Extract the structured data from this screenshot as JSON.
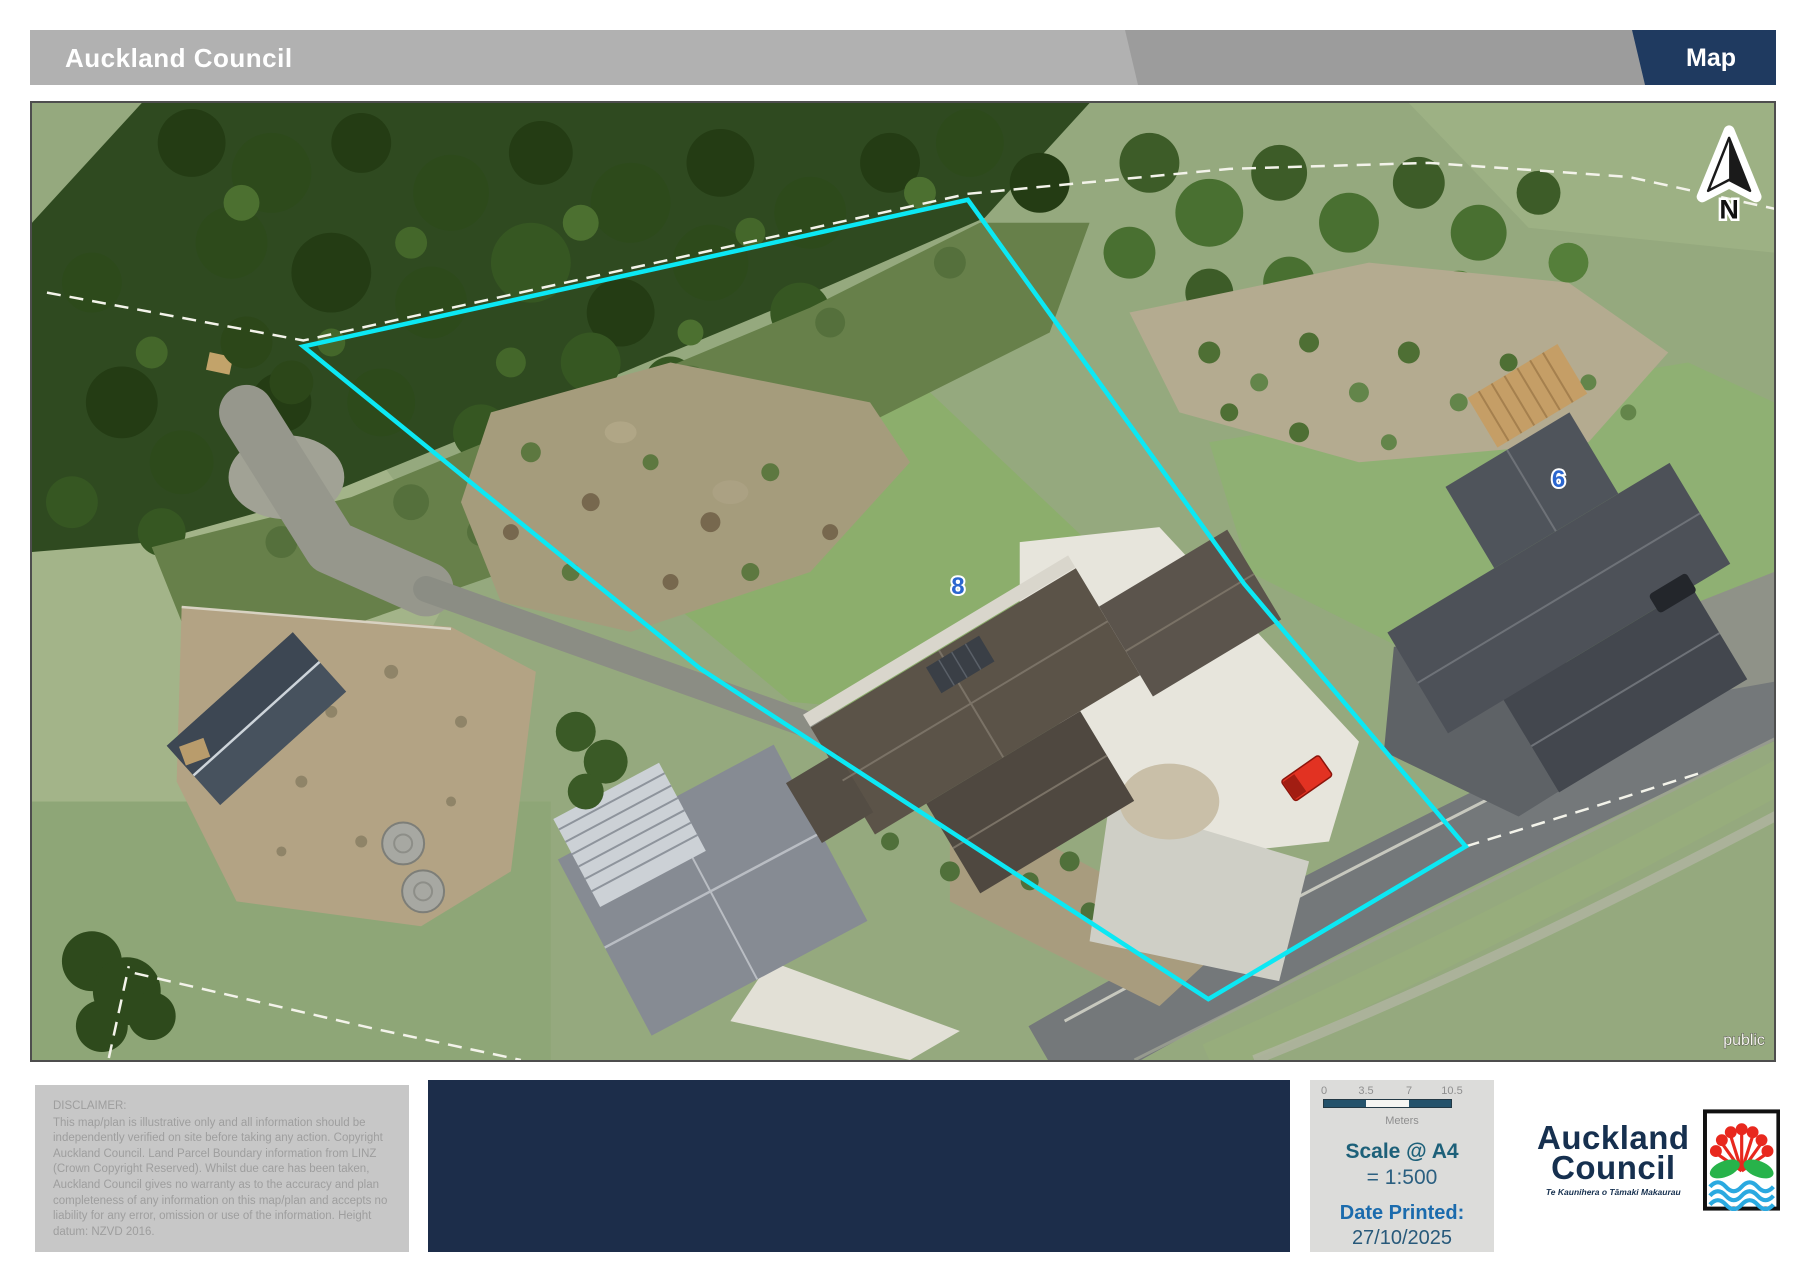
{
  "header": {
    "title": "Auckland Council",
    "tab": "Map"
  },
  "map": {
    "labels": {
      "house_8": "8",
      "house_6": "6",
      "public": "public",
      "north": "N"
    },
    "boundary_color": "#0CE8F4"
  },
  "footer": {
    "disclaimer": {
      "title": "DISCLAIMER:",
      "body": "This map/plan is illustrative only and all information should be independently verified on site before taking any action. Copyright Auckland Council.  Land Parcel Boundary information from LINZ (Crown Copyright Reserved). Whilst due care has been taken, Auckland Council gives no warranty as to the accuracy and plan completeness of any information on this map/plan and accepts no liability for any error, omission or use of the information. Height datum: NZVD 2016."
    },
    "scale": {
      "ticks": [
        "0",
        "3.5",
        "7",
        "10.5"
      ],
      "units": "Meters",
      "scale_label": "Scale @ A4",
      "scale_value": "= 1:500",
      "date_label": "Date Printed:",
      "date_value": "27/10/2025"
    },
    "logo": {
      "line1": "Auckland",
      "line2": "Council",
      "tagline": "Te Kaunihera o Tāmaki Makaurau"
    }
  },
  "colors": {
    "header_gray": "#b1b1b1",
    "header_dark_gray": "#9c9c9c",
    "header_navy": "#1f3a60",
    "panel_navy": "#1c2d4a"
  }
}
